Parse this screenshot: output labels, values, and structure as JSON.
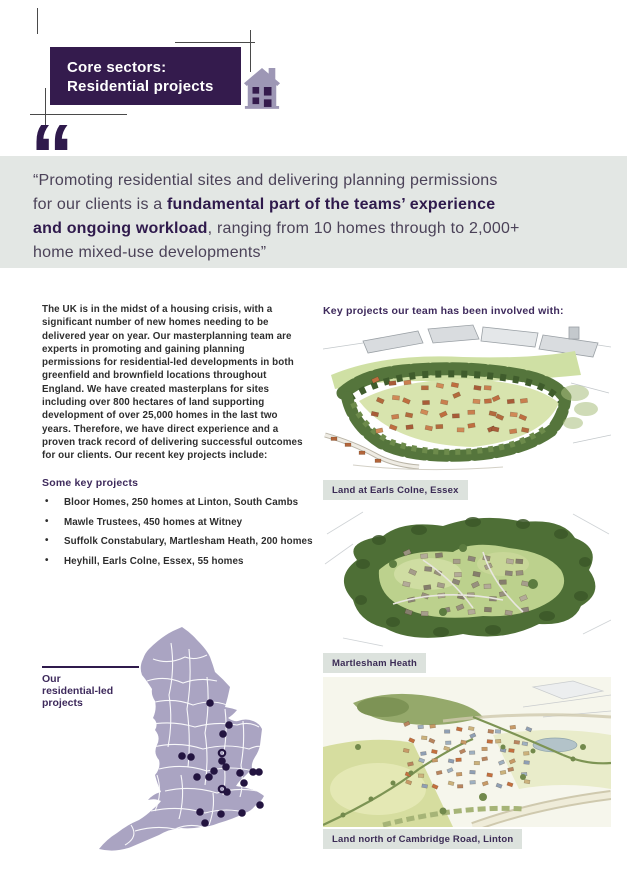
{
  "header": {
    "title_line1": "Core sectors:",
    "title_line2": "Residential projects",
    "box_color": "#341b4d",
    "icon": "house-icon",
    "icon_color": "#9d97b5"
  },
  "quote": {
    "band_color": "#e3e7e4",
    "mark": "“",
    "line1": "“Promoting residential sites and delivering planning permissions",
    "line2_regular": "for our clients is a ",
    "line2_bold": "fundamental part of the teams’ experience",
    "line3_bold": "and ongoing workload",
    "line3_regular": ", ranging from 10 homes through to 2,000+",
    "line4": "home mixed-use developments”"
  },
  "left": {
    "paragraph": "The UK is in the midst of a housing crisis, with a significant number of new homes needing to be delivered year on year. Our masterplanning team are experts in promoting and gaining planning permissions for residential-led developments in both greenfield and brownfield locations throughout England. We have created masterplans for sites including over 800 hectares of land supporting development of over 25,000 homes in the last two years. Therefore, we have direct experience and a proven track record of delivering successful outcomes for our clients. Our recent key projects include:",
    "projects_heading": "Some key projects",
    "bullets": [
      "Bloor Homes, 250 homes at Linton, South Cambs",
      "Mawle Trustees, 450 homes at Witney",
      "Suffolk Constabulary, Martlesham Heath, 200 homes",
      "Heyhill, Earls Colne, Essex, 55 homes"
    ]
  },
  "map": {
    "label_line1": "Our",
    "label_line2": "residential-led",
    "label_line3": "projects",
    "fill": "#aaa4c2",
    "dot_color": "#231440",
    "dots": [
      [
        115,
        78
      ],
      [
        134,
        100
      ],
      [
        128,
        109
      ],
      [
        87,
        131
      ],
      [
        96,
        132
      ],
      [
        127,
        128,
        1
      ],
      [
        127,
        136
      ],
      [
        131,
        142
      ],
      [
        119,
        146
      ],
      [
        114,
        152
      ],
      [
        102,
        152
      ],
      [
        145,
        148
      ],
      [
        149,
        158
      ],
      [
        158,
        147
      ],
      [
        164,
        147
      ],
      [
        127,
        164,
        1
      ],
      [
        132,
        167
      ],
      [
        105,
        187
      ],
      [
        126,
        189
      ],
      [
        147,
        188
      ],
      [
        165,
        180
      ],
      [
        110,
        198
      ]
    ]
  },
  "right": {
    "heading": "Key projects our team has been involved with:",
    "captions": [
      "Land at Earls Colne, Essex",
      "Martlesham Heath",
      "Land north of Cambridge Road, Linton"
    ]
  }
}
